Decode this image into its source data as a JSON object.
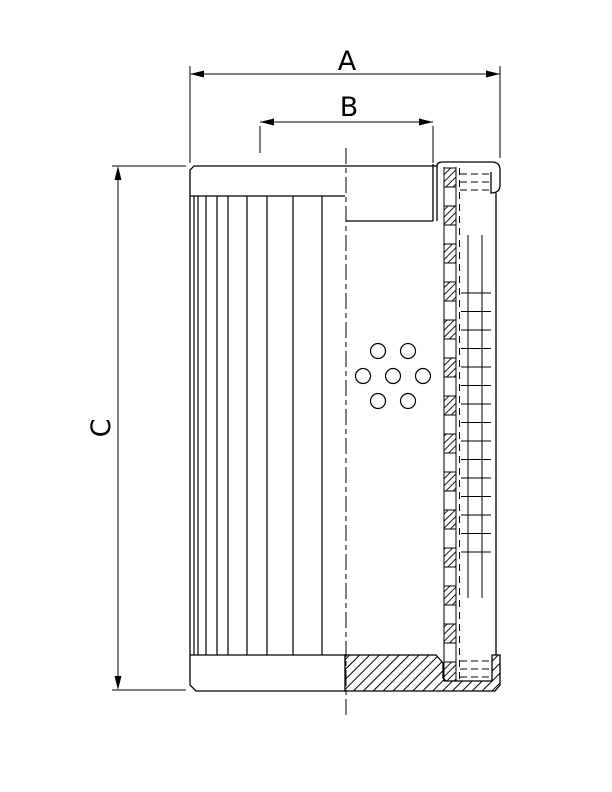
{
  "figure": {
    "kind": "technical-drawing"
  },
  "dimension_labels": {
    "a": "A",
    "b": "B",
    "c": "C"
  },
  "colors": {
    "line": "#000000",
    "background": "#ffffff"
  }
}
